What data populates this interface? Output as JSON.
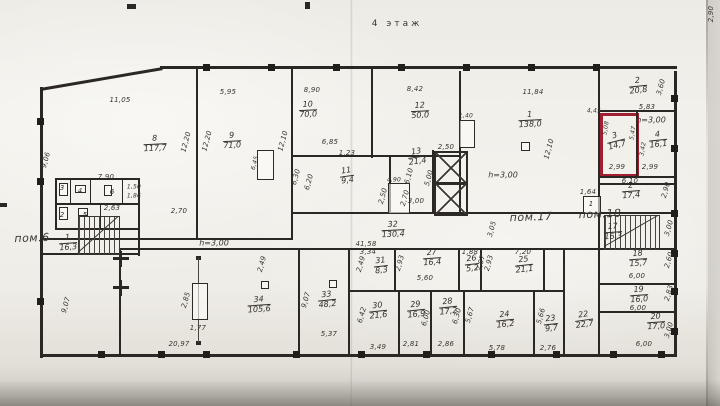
{
  "title": {
    "text": "4 этаж"
  },
  "colors": {
    "highlight": "#a01f30",
    "ink": "#2a2724",
    "paper": "#efede7"
  },
  "zone_labels": [
    {
      "text": "пом.6",
      "x": 32,
      "y": 238
    },
    {
      "text": "пом.17",
      "x": 531,
      "y": 217
    },
    {
      "text": "пом.18",
      "x": 600,
      "y": 214
    }
  ],
  "height_labels": [
    {
      "text": "h=3,00",
      "x": 503,
      "y": 175
    },
    {
      "text": "h=3,00",
      "x": 651,
      "y": 120
    },
    {
      "text": "h=3,00",
      "x": 214,
      "y": 243
    }
  ],
  "highlighted_room": {
    "number": "3",
    "area": "14,7"
  },
  "rooms": [
    {
      "n": "8",
      "a": "117,7",
      "x": 155,
      "y": 144
    },
    {
      "n": "9",
      "a": "71,0",
      "x": 232,
      "y": 141
    },
    {
      "n": "10",
      "a": "70,0",
      "x": 308,
      "y": 110
    },
    {
      "n": "12",
      "a": "50,0",
      "x": 420,
      "y": 111
    },
    {
      "n": "11",
      "a": "9,4",
      "x": 347,
      "y": 176,
      "r": -8
    },
    {
      "n": "13",
      "a": "21,4",
      "x": 417,
      "y": 157,
      "r": -8
    },
    {
      "n": "1",
      "a": "138,0",
      "x": 530,
      "y": 120
    },
    {
      "n": "2",
      "a": "20,8",
      "x": 638,
      "y": 86,
      "r": -6
    },
    {
      "n": "3",
      "a": "14,7",
      "x": 616,
      "y": 141,
      "r": -14,
      "red": true
    },
    {
      "n": "4",
      "a": "16,1",
      "x": 658,
      "y": 140,
      "r": -6
    },
    {
      "n": "2",
      "a": "17,4",
      "x": 631,
      "y": 191,
      "r": -4
    },
    {
      "n": "1",
      "a": "16,3",
      "x": 68,
      "y": 243,
      "r": -4
    },
    {
      "n": "17",
      "a": "16,3",
      "x": 613,
      "y": 232,
      "r": -4
    },
    {
      "n": "18",
      "a": "15,7",
      "x": 638,
      "y": 259,
      "r": -4
    },
    {
      "n": "19",
      "a": "16,0",
      "x": 639,
      "y": 295,
      "r": -4
    },
    {
      "n": "20",
      "a": "17,0",
      "x": 656,
      "y": 322,
      "r": -4
    },
    {
      "n": "22",
      "a": "22,7",
      "x": 584,
      "y": 320,
      "r": -8
    },
    {
      "n": "23",
      "a": "9,7",
      "x": 551,
      "y": 324,
      "r": -6
    },
    {
      "n": "24",
      "a": "16,2",
      "x": 505,
      "y": 320,
      "r": -6
    },
    {
      "n": "25",
      "a": "21,1",
      "x": 524,
      "y": 265,
      "r": -6
    },
    {
      "n": "26",
      "a": "5,2",
      "x": 472,
      "y": 264,
      "r": -6
    },
    {
      "n": "27",
      "a": "16,4",
      "x": 432,
      "y": 258,
      "r": -4
    },
    {
      "n": "28",
      "a": "17,2",
      "x": 448,
      "y": 307,
      "r": -6
    },
    {
      "n": "29",
      "a": "16,9",
      "x": 416,
      "y": 310,
      "r": -6
    },
    {
      "n": "30",
      "a": "21,6",
      "x": 378,
      "y": 311,
      "r": -6
    },
    {
      "n": "31",
      "a": "8,3",
      "x": 381,
      "y": 266,
      "r": -6
    },
    {
      "n": "32",
      "a": "130,4",
      "x": 393,
      "y": 230
    },
    {
      "n": "33",
      "a": "48,2",
      "x": 327,
      "y": 300,
      "r": -6
    },
    {
      "n": "34",
      "a": "105,6",
      "x": 259,
      "y": 305,
      "r": -4
    }
  ],
  "cell_labels": [
    {
      "t": "3",
      "x": 62,
      "y": 188
    },
    {
      "t": "4",
      "x": 80,
      "y": 191
    },
    {
      "t": "6",
      "x": 112,
      "y": 192
    },
    {
      "t": "2",
      "x": 62,
      "y": 215
    },
    {
      "t": "5",
      "x": 85,
      "y": 215
    },
    {
      "t": "1",
      "x": 591,
      "y": 204
    }
  ],
  "dims": [
    {
      "t": "11,05",
      "x": 120,
      "y": 100
    },
    {
      "t": "5,95",
      "x": 228,
      "y": 92
    },
    {
      "t": "8,90",
      "x": 312,
      "y": 90
    },
    {
      "t": "8,42",
      "x": 415,
      "y": 89
    },
    {
      "t": "11,84",
      "x": 533,
      "y": 92
    },
    {
      "t": "5,83",
      "x": 647,
      "y": 107
    },
    {
      "t": "3,60",
      "x": 661,
      "y": 87,
      "r": -75
    },
    {
      "t": "9,06",
      "x": 46,
      "y": 160,
      "r": -75
    },
    {
      "t": "12,20",
      "x": 186,
      "y": 142,
      "r": -75
    },
    {
      "t": "12,20",
      "x": 207,
      "y": 141,
      "r": -75
    },
    {
      "t": "12,10",
      "x": 283,
      "y": 141,
      "r": -75
    },
    {
      "t": "12,10",
      "x": 549,
      "y": 149,
      "r": -75
    },
    {
      "t": "7,90",
      "x": 106,
      "y": 177
    },
    {
      "t": "2,63",
      "x": 112,
      "y": 208
    },
    {
      "t": "2,70",
      "x": 179,
      "y": 211
    },
    {
      "t": "1,50",
      "x": 134,
      "y": 187,
      "tiny": true
    },
    {
      "t": "1,86",
      "x": 134,
      "y": 196,
      "tiny": true
    },
    {
      "t": "6,85",
      "x": 330,
      "y": 142
    },
    {
      "t": "1,23",
      "x": 347,
      "y": 153
    },
    {
      "t": "6,30",
      "x": 296,
      "y": 177,
      "r": -75
    },
    {
      "t": "6,20",
      "x": 309,
      "y": 182,
      "r": -75
    },
    {
      "t": "2,50",
      "x": 446,
      "y": 147
    },
    {
      "t": "5,00",
      "x": 429,
      "y": 178,
      "r": -75
    },
    {
      "t": "3,00",
      "x": 416,
      "y": 201
    },
    {
      "t": "2,50",
      "x": 383,
      "y": 196,
      "r": -75
    },
    {
      "t": "2,70",
      "x": 405,
      "y": 198,
      "r": -75
    },
    {
      "t": "6,10",
      "x": 409,
      "y": 176,
      "r": -75
    },
    {
      "t": "4,90",
      "x": 394,
      "y": 180,
      "tiny": true
    },
    {
      "t": "6,45",
      "x": 255,
      "y": 163,
      "r": -75,
      "tiny": true
    },
    {
      "t": "1,40",
      "x": 466,
      "y": 116,
      "tiny": true
    },
    {
      "t": "41,58",
      "x": 366,
      "y": 244
    },
    {
      "t": "3,05",
      "x": 492,
      "y": 229,
      "r": -75
    },
    {
      "t": "20,97",
      "x": 179,
      "y": 344
    },
    {
      "t": "9,07",
      "x": 66,
      "y": 305,
      "r": -75
    },
    {
      "t": "2,85",
      "x": 186,
      "y": 300,
      "r": -75
    },
    {
      "t": "1,77",
      "x": 198,
      "y": 328
    },
    {
      "t": "2,49",
      "x": 262,
      "y": 264,
      "r": -75
    },
    {
      "t": "9,07",
      "x": 306,
      "y": 300,
      "r": -75
    },
    {
      "t": "5,37",
      "x": 329,
      "y": 334
    },
    {
      "t": "3,34",
      "x": 368,
      "y": 252
    },
    {
      "t": "2,49",
      "x": 361,
      "y": 264,
      "r": -75
    },
    {
      "t": "2,93",
      "x": 400,
      "y": 263,
      "r": -75
    },
    {
      "t": "5,60",
      "x": 425,
      "y": 278
    },
    {
      "t": "1,88",
      "x": 470,
      "y": 252
    },
    {
      "t": "2,87",
      "x": 481,
      "y": 263,
      "r": -75
    },
    {
      "t": "2,93",
      "x": 489,
      "y": 263,
      "r": -75
    },
    {
      "t": "7,20",
      "x": 523,
      "y": 252
    },
    {
      "t": "6,42",
      "x": 362,
      "y": 315,
      "r": -75
    },
    {
      "t": "3,49",
      "x": 378,
      "y": 347
    },
    {
      "t": "6,00",
      "x": 426,
      "y": 318,
      "r": -75
    },
    {
      "t": "2,81",
      "x": 411,
      "y": 344
    },
    {
      "t": "6,30",
      "x": 457,
      "y": 316,
      "r": -75
    },
    {
      "t": "2,86",
      "x": 446,
      "y": 344
    },
    {
      "t": "5,67",
      "x": 470,
      "y": 315,
      "r": -75
    },
    {
      "t": "5,78",
      "x": 497,
      "y": 348
    },
    {
      "t": "5,66",
      "x": 541,
      "y": 316,
      "r": -75
    },
    {
      "t": "2,76",
      "x": 548,
      "y": 348
    },
    {
      "t": "1,64",
      "x": 588,
      "y": 192
    },
    {
      "t": "6,10",
      "x": 630,
      "y": 181
    },
    {
      "t": "2,90",
      "x": 666,
      "y": 190,
      "r": -75
    },
    {
      "t": "2,99",
      "x": 617,
      "y": 167
    },
    {
      "t": "2,99",
      "x": 650,
      "y": 167
    },
    {
      "t": "5,08",
      "x": 606,
      "y": 128,
      "r": -80,
      "tiny": true
    },
    {
      "t": "5,47",
      "x": 633,
      "y": 133,
      "r": -80,
      "tiny": true
    },
    {
      "t": "3,42",
      "x": 643,
      "y": 149,
      "r": -80,
      "tiny": true
    },
    {
      "t": "4,45",
      "x": 594,
      "y": 111,
      "tiny": true
    },
    {
      "t": "3,00",
      "x": 669,
      "y": 228,
      "r": -75
    },
    {
      "t": "6,00",
      "x": 637,
      "y": 276
    },
    {
      "t": "2,60",
      "x": 669,
      "y": 260,
      "r": -75
    },
    {
      "t": "6,00",
      "x": 638,
      "y": 308
    },
    {
      "t": "2,83",
      "x": 669,
      "y": 293,
      "r": -75
    },
    {
      "t": "6,00",
      "x": 644,
      "y": 344
    },
    {
      "t": "3,00",
      "x": 669,
      "y": 330,
      "r": -75
    },
    {
      "t": "2,90",
      "x": 711,
      "y": 14,
      "r": -90
    }
  ]
}
